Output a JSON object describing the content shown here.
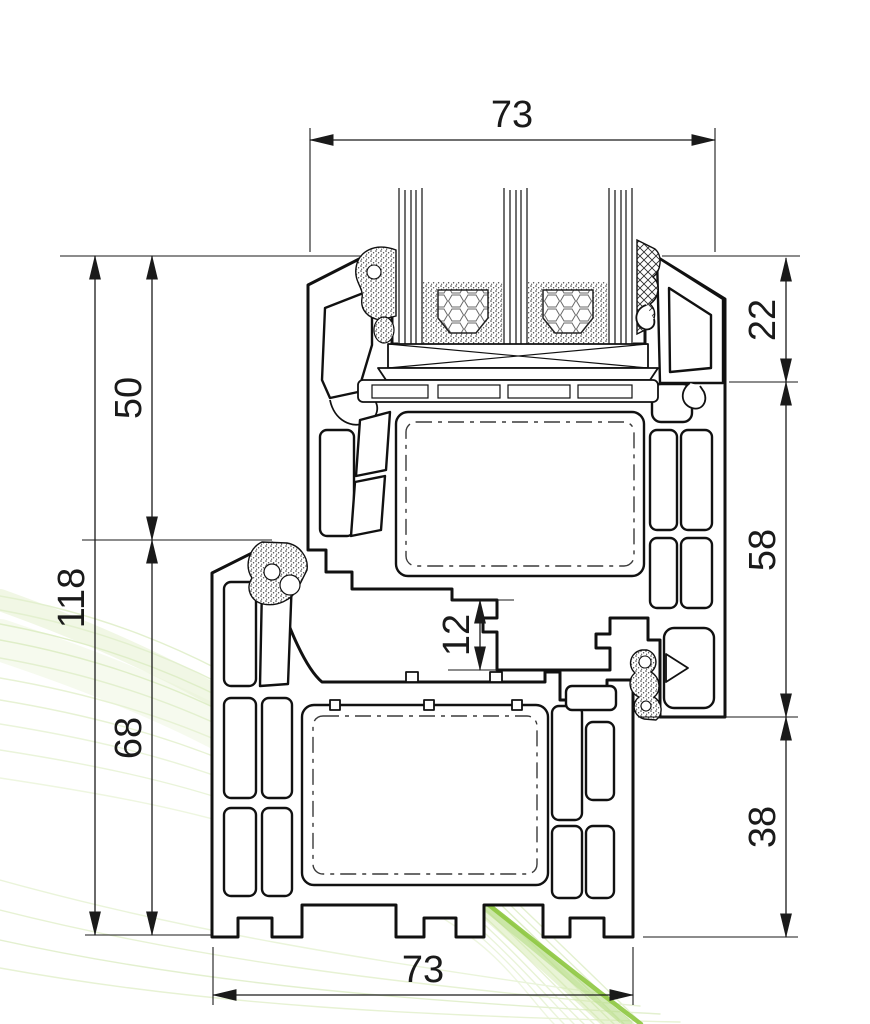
{
  "drawing": {
    "title": "PVC window frame and sash cross-section with triple glazing",
    "dimensions": {
      "top_width": "73",
      "bead_height": "22",
      "upper_left_height": "50",
      "total_height": "118",
      "sash_height": "58",
      "rebate_step": "12",
      "frame_height": "68",
      "frame_right_height": "38",
      "bottom_width": "73"
    },
    "colors": {
      "line": "#1a1a1a",
      "accent_green": "#8dc63f",
      "accent_green_soft": "#b5dc85",
      "light_green": "#e3f0cf"
    }
  }
}
